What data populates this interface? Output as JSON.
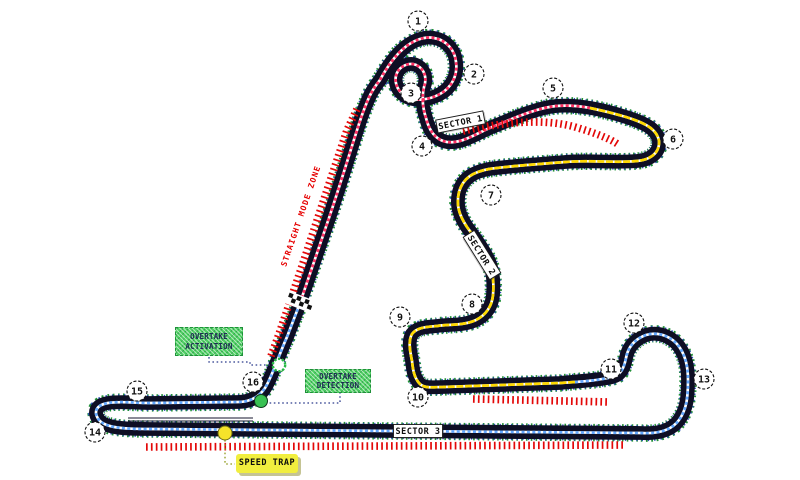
{
  "map_title": "Shanghai circuit track map",
  "colors": {
    "background": "#ffffff",
    "track": "#0e0e24",
    "sector1_line": "#ff2f63",
    "sector2_line": "#ffd900",
    "sector3_line": "#63a8ff",
    "zone_ticks": "#e30808",
    "overtake_box": "#4fd063",
    "speed_trap_box": "#f1ee3e",
    "zone_text": "#e60000",
    "activation_marker": "#28b945",
    "detection_marker": "#39c153",
    "speed_trap_marker": "#f5e32a"
  },
  "corners": [
    {
      "n": "1",
      "x": 418,
      "y": 21
    },
    {
      "n": "2",
      "x": 474,
      "y": 74
    },
    {
      "n": "3",
      "x": 411,
      "y": 93
    },
    {
      "n": "4",
      "x": 422,
      "y": 146
    },
    {
      "n": "5",
      "x": 553,
      "y": 88
    },
    {
      "n": "6",
      "x": 673,
      "y": 139
    },
    {
      "n": "7",
      "x": 491,
      "y": 195
    },
    {
      "n": "8",
      "x": 472,
      "y": 304
    },
    {
      "n": "9",
      "x": 400,
      "y": 317
    },
    {
      "n": "10",
      "x": 418,
      "y": 397
    },
    {
      "n": "11",
      "x": 611,
      "y": 369
    },
    {
      "n": "12",
      "x": 634,
      "y": 323
    },
    {
      "n": "13",
      "x": 704,
      "y": 379
    },
    {
      "n": "14",
      "x": 95,
      "y": 432
    },
    {
      "n": "15",
      "x": 137,
      "y": 391
    },
    {
      "n": "16",
      "x": 253,
      "y": 382
    }
  ],
  "sector_labels": {
    "s1": "SECTOR 1",
    "s2": "SECTOR 2",
    "s3": "SECTOR 3"
  },
  "zone_label": "STRAIGHT MODE ZONE",
  "annotations": {
    "overtake_activation": {
      "line1": "OVERTAKE",
      "line2": "ACTIVATION"
    },
    "overtake_detection": {
      "line1": "OVERTAKE",
      "line2": "DETECTION"
    },
    "speed_trap": "SPEED TRAP"
  }
}
